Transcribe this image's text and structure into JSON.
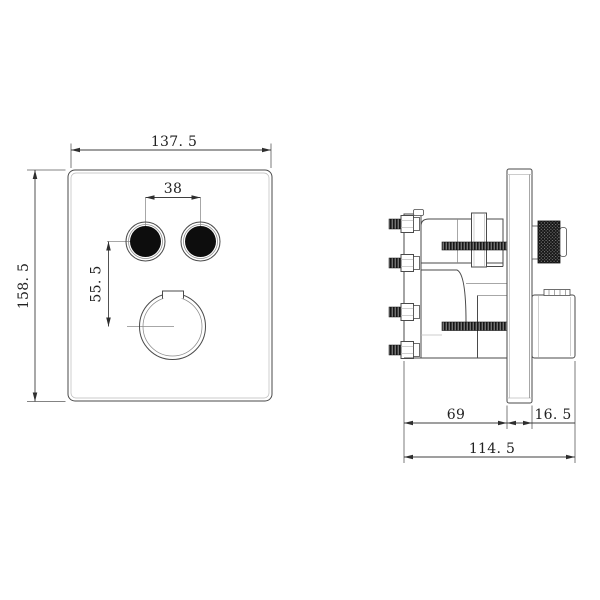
{
  "page": {
    "background": "#ffffff"
  },
  "colors": {
    "line": "#4a4a4a",
    "dark_fill": "#161616",
    "dim_text": "#222222"
  },
  "front_view": {
    "dim_width": "137. 5",
    "dim_height": "158. 5",
    "dim_button_spacing": "38",
    "dim_button_to_knob": "55. 5"
  },
  "side_view": {
    "dim_body_depth": "69",
    "dim_plate_thickness": "16. 5",
    "dim_total_depth": "114. 5"
  }
}
